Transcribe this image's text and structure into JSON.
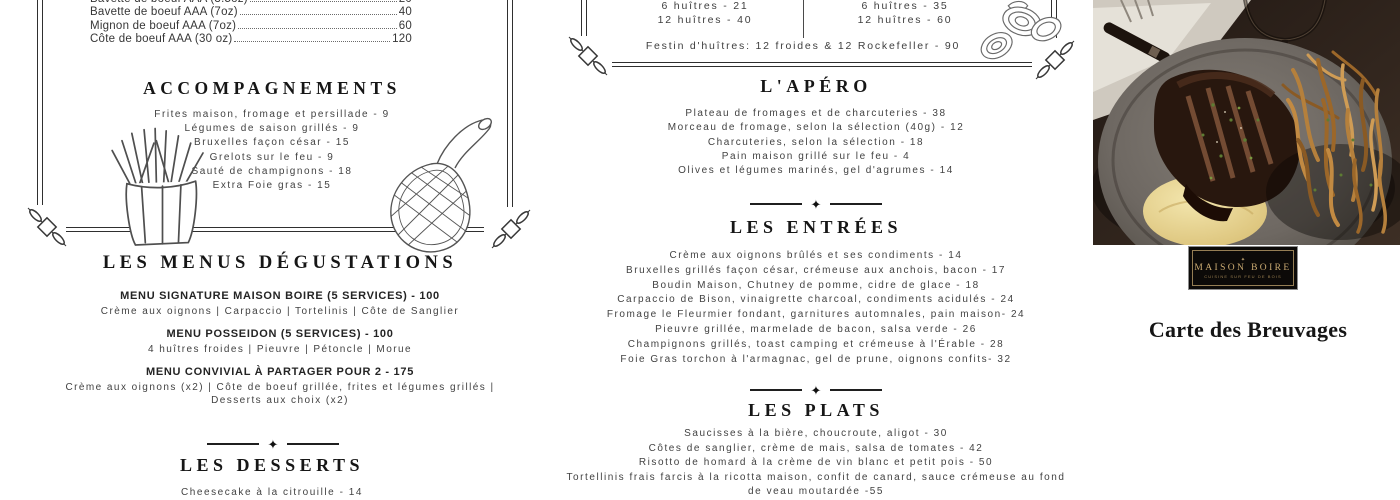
{
  "colors": {
    "ink": "#414141",
    "heading": "#161616",
    "gold": "#c8aa74",
    "logo_background": "#0c0a08"
  },
  "divider_glyph": "✦",
  "left_panel": {
    "cuts": [
      {
        "name": "Bavette de boeuf AAA (3.5oz)",
        "price": "20"
      },
      {
        "name": "Bavette de boeuf AAA (7oz)",
        "price": "40"
      },
      {
        "name": "Mignon de boeuf AAA (7oz)",
        "price": "60"
      },
      {
        "name": "Côte de boeuf AAA (30 oz)",
        "price": "120"
      }
    ],
    "accompagnements": {
      "title": "ACCOMPAGNEMENTS",
      "items": [
        "Frites maison, fromage et persillade - 9",
        "Légumes de saison grillés - 9",
        "Bruxelles façon césar - 15",
        "Grelots sur le feu - 9",
        "Sauté de champignons - 18",
        "Extra Foie gras - 15"
      ]
    },
    "menus": {
      "title": "LES MENUS DÉGUSTATIONS",
      "entries": [
        {
          "heading": "MENU SIGNATURE MAISON BOIRE (5 SERVICES) - 100",
          "detail": "Crème aux oignons | Carpaccio | Tortelinis | Côte de Sanglier"
        },
        {
          "heading": "MENU POSSEIDON (5 SERVICES) - 100",
          "detail": "4 huîtres froides | Pieuvre | Pétoncle | Morue"
        },
        {
          "heading": "MENU CONVIVIAL À PARTAGER POUR 2 - 175",
          "detail": "Crème aux oignons (x2) | Côte de boeuf grillée, frites et légumes grillés | Desserts aux choix (x2)"
        }
      ]
    },
    "desserts": {
      "title": "LES DESSERTS",
      "items": [
        "Cheesecake à la citrouille - 14"
      ]
    }
  },
  "center_panel": {
    "oysters": {
      "left_column": [
        "6 huîtres - 21",
        "12 huîtres - 40"
      ],
      "right_column": [
        "6 huîtres - 35",
        "12 huîtres - 60"
      ],
      "festin": "Festin d'huîtres: 12 froides & 12 Rockefeller - 90"
    },
    "apero": {
      "title": "L'APÉRO",
      "items": [
        "Plateau de fromages et de charcuteries - 38",
        "Morceau de fromage, selon la sélection (40g) - 12",
        "Charcuteries, selon la sélection - 18",
        "Pain maison grillé sur le feu - 4",
        "Olives et légumes marinés, gel d'agrumes - 14"
      ]
    },
    "entrees": {
      "title": "LES ENTRÉES",
      "items": [
        "Crème aux oignons brûlés et ses condiments - 14",
        "Bruxelles grillés façon césar, crémeuse aux anchois, bacon - 17",
        "Boudin Maison, Chutney de pomme, cidre de glace - 18",
        "Carpaccio de Bison, vinaigrette charcoal, condiments acidulés - 24",
        "Fromage le Fleurmier fondant, garnitures automnales, pain maison- 24",
        "Pieuvre grillée, marmelade de bacon, salsa verde - 26",
        "Champignons grillés, toast camping et crémeuse à l'Érable - 28",
        "Foie Gras torchon à l'armagnac, gel de prune, oignons confits- 32"
      ]
    },
    "plats": {
      "title": "LES PLATS",
      "items": [
        "Saucisses à la bière, choucroute, aligot - 30",
        "Côtes de sanglier, crème de mais, salsa de tomates - 42",
        "Risotto de homard à la crème de vin blanc et petit pois - 50",
        "Tortellinis frais farcis à la ricotta maison, confit de canard, sauce crémeuse au fond de veau moutardée -55"
      ]
    }
  },
  "right_panel": {
    "logo": {
      "ornament": "✦",
      "name": "MAISON BOIRE",
      "tagline": "CUISINE SUR FEU DE BOIS"
    },
    "title": "Carte des Breuvages"
  }
}
